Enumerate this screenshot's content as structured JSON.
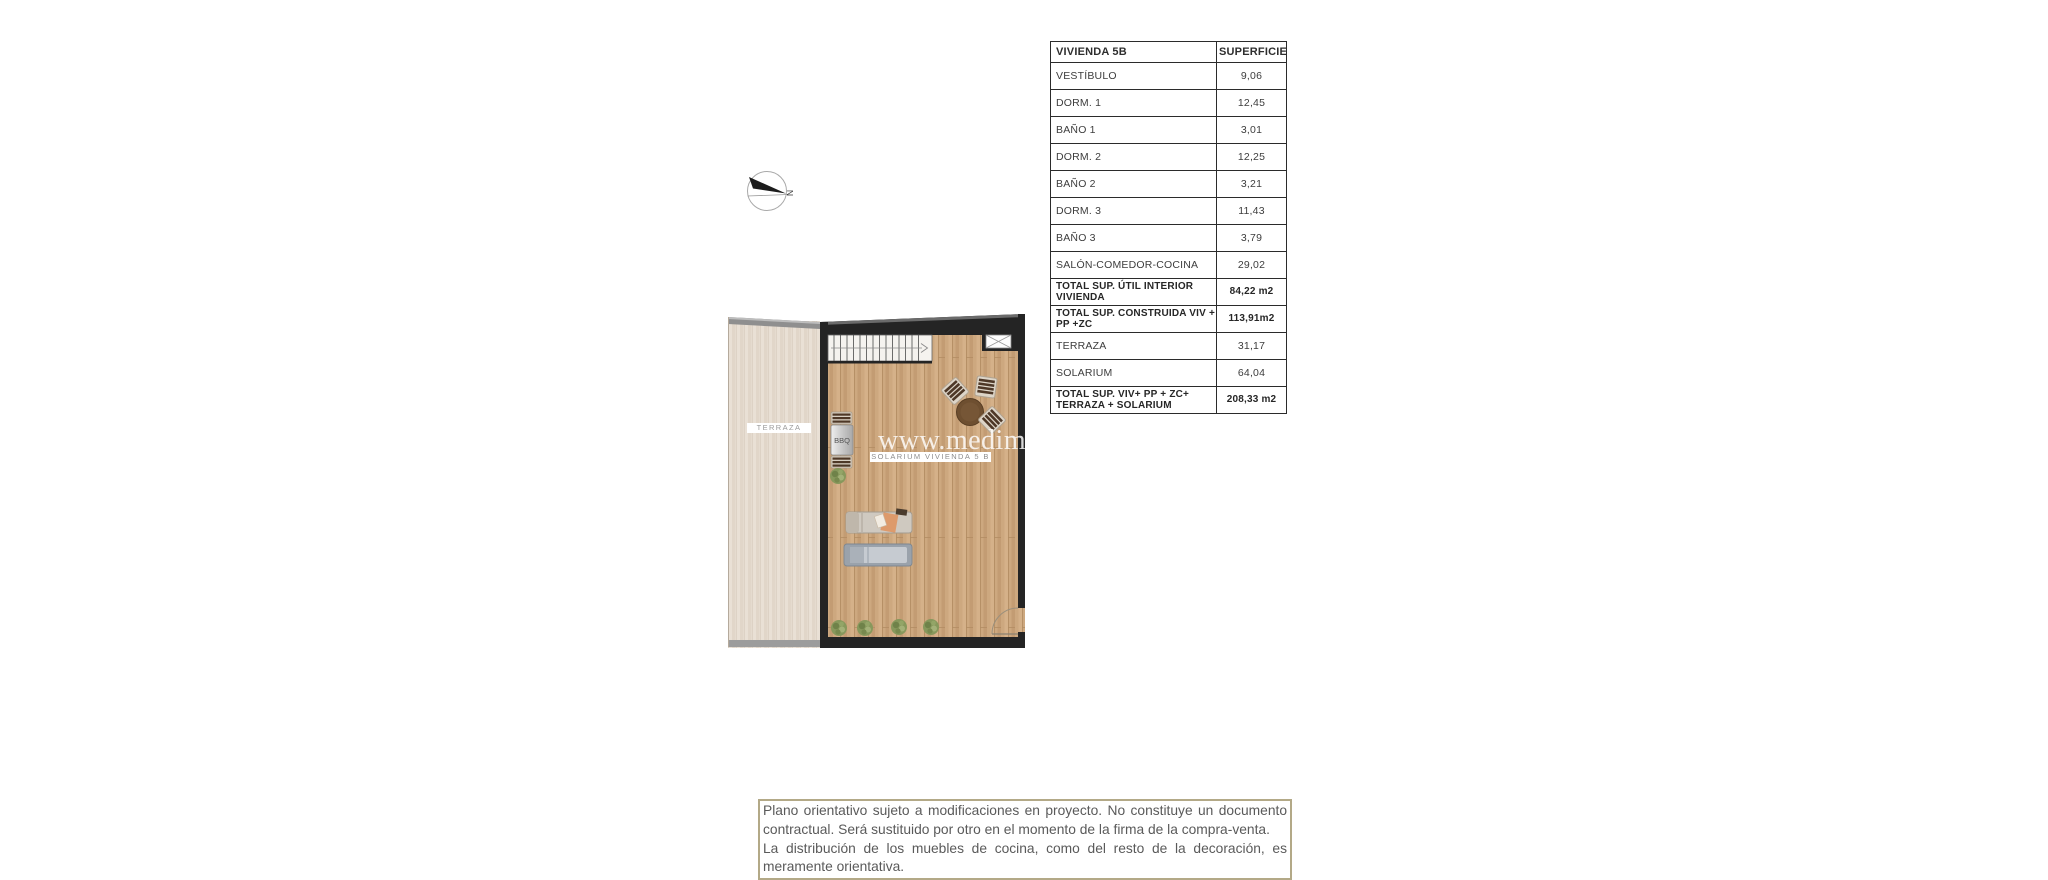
{
  "compass": {
    "label": "N"
  },
  "floor_plan": {
    "labels": {
      "terraza": "TERRAZA",
      "bbq": "BBQ",
      "solarium": "SOLARIUM VIVIENDA 5 B"
    },
    "watermark": "www.medima",
    "colors": {
      "wall": "#242424",
      "solarium_floor": "#cda87f",
      "terraza_floor": "#e9e0d5",
      "table_wood": "#6e4f30",
      "plant_green": "#87985c",
      "lounger_gray": "#9aa2ab"
    }
  },
  "area_table": {
    "header": {
      "name": "VIVIENDA 5B",
      "value": "SUPERFICIE"
    },
    "rows": [
      {
        "name": "VESTÍBULO",
        "value": "9,06"
      },
      {
        "name": "DORM. 1",
        "value": "12,45"
      },
      {
        "name": "BAÑO 1",
        "value": "3,01"
      },
      {
        "name": "DORM. 2",
        "value": "12,25"
      },
      {
        "name": "BAÑO 2",
        "value": "3,21"
      },
      {
        "name": "DORM. 3",
        "value": "11,43"
      },
      {
        "name": "BAÑO 3",
        "value": "3,79"
      },
      {
        "name": "SALÓN-COMEDOR-COCINA",
        "value": "29,02"
      },
      {
        "name": "TOTAL SUP. ÚTIL INTERIOR VIVIENDA",
        "value": "84,22 m2"
      },
      {
        "name": "TOTAL SUP. CONSTRUIDA VIV + PP +ZC",
        "value": "113,91m2"
      },
      {
        "name": "TERRAZA",
        "value": "31,17"
      },
      {
        "name": "SOLARIUM",
        "value": "64,04"
      },
      {
        "name": "TOTAL SUP. VIV+ PP + ZC+ TERRAZA + SOLARIUM",
        "value": "208,33 m2"
      }
    ]
  },
  "disclaimer": {
    "paragraph1": "Plano orientativo sujeto a modificaciones en proyecto. No constituye un documento contractual. Será sustituido por otro en el momento de la firma de la compra-venta.",
    "paragraph2": "La distribución de los muebles de cocina, como del resto de la decoración, es meramente orientativa."
  }
}
